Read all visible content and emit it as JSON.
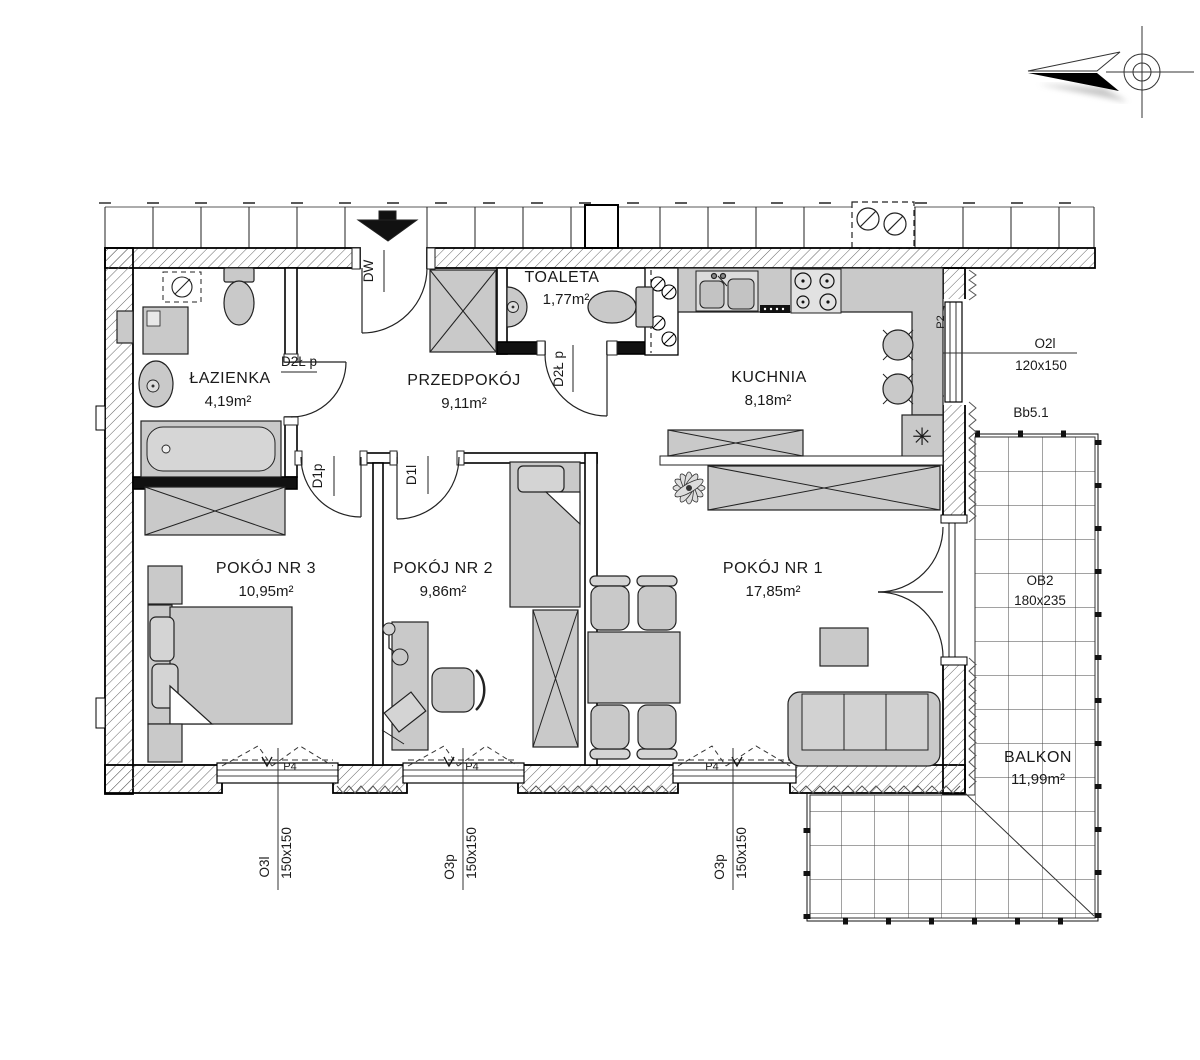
{
  "rooms": {
    "lazienka": {
      "name": "ŁAZIENKA",
      "area": "4,19m²"
    },
    "przedpokoj": {
      "name": "PRZEDPOKÓJ",
      "area": "9,11m²"
    },
    "toaleta": {
      "name": "TOALETA",
      "area": "1,77m²"
    },
    "kuchnia": {
      "name": "KUCHNIA",
      "area": "8,18m²"
    },
    "pokoj3": {
      "name": "POKÓJ NR 3",
      "area": "10,95m²"
    },
    "pokoj2": {
      "name": "POKÓJ NR 2",
      "area": "9,86m²"
    },
    "pokoj1": {
      "name": "POKÓJ NR 1",
      "area": "17,85m²"
    },
    "balkon": {
      "name": "BALKON",
      "area": "11,99m²"
    }
  },
  "doors": {
    "entrance": "DW",
    "bathroom": "D2Ł p",
    "toilet": "D2Ł p",
    "room3": "D1p",
    "room2": "D1l"
  },
  "windows": {
    "w1": {
      "name": "O3l",
      "size": "150x150"
    },
    "w2": {
      "name": "O3p",
      "size": "150x150"
    },
    "w3": {
      "name": "O3p",
      "size": "150x150"
    },
    "kitchen": {
      "name": "O2l",
      "size": "120x150",
      "vent": "P2"
    },
    "sill_label": "P4"
  },
  "balcony": {
    "door_code": "OB2",
    "door_size": "180x235",
    "section_code": "Bb5.1"
  },
  "symbols": {
    "fridge": "✳"
  },
  "colors": {
    "furniture": "#c9c9c9",
    "wall_line": "#111111",
    "hatch": "#555555"
  }
}
